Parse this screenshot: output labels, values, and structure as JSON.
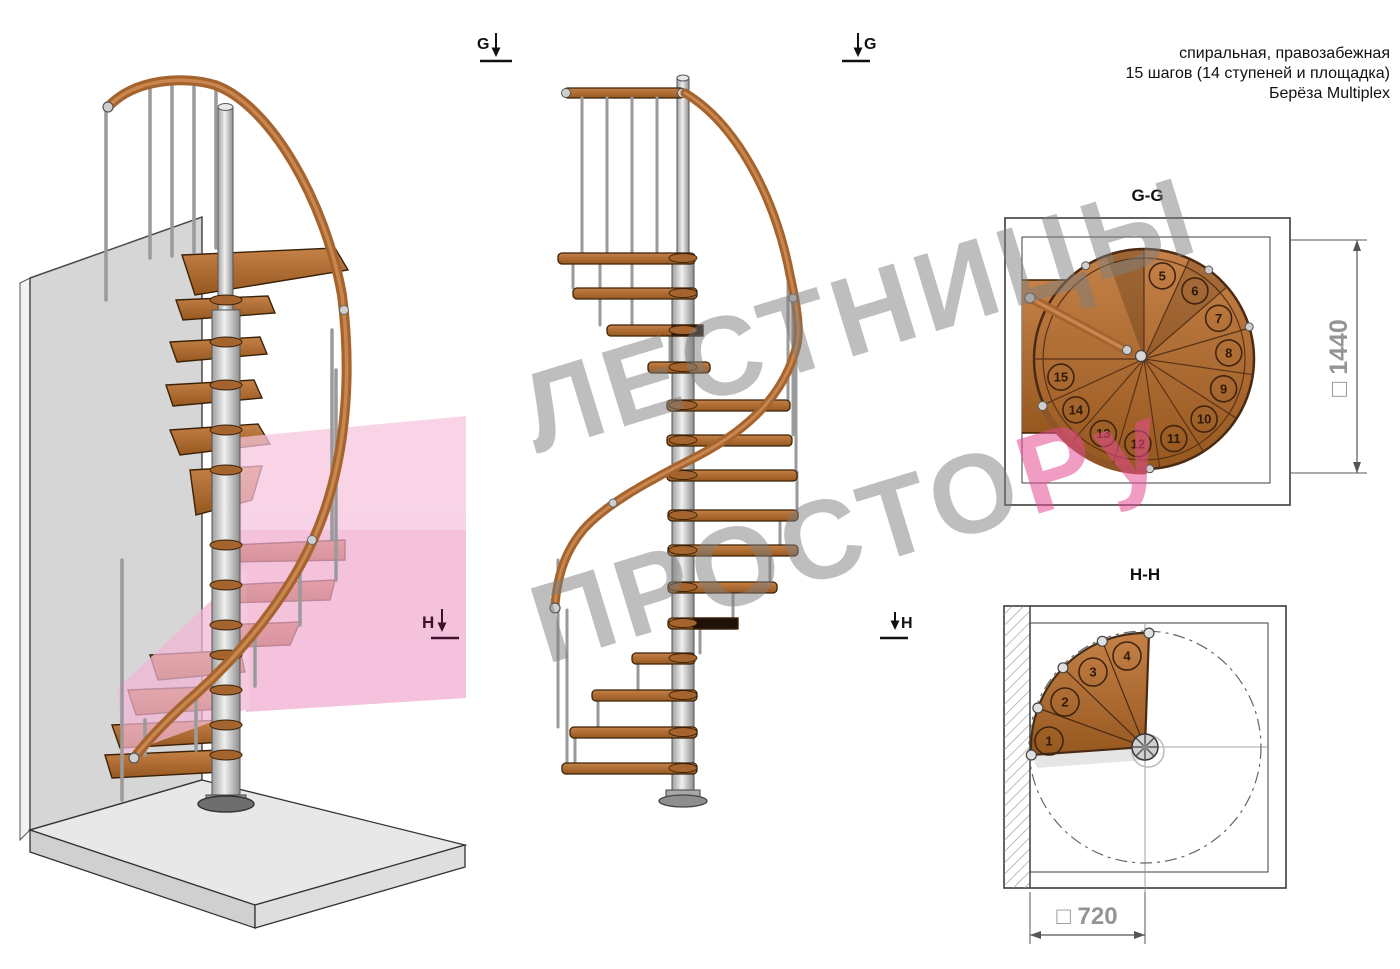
{
  "info": {
    "line1": "спиральная, правозабежная",
    "line2": "15 шагов (14 ступеней и площадка)",
    "line3": "Берёза Multiplex"
  },
  "markers": {
    "g": "G",
    "h": "H"
  },
  "plan_gg": {
    "title": "G-G",
    "dim_label": "□ 1440",
    "steps": [
      "5",
      "6",
      "7",
      "8",
      "9",
      "10",
      "11",
      "12",
      "13",
      "14",
      "15"
    ]
  },
  "plan_hh": {
    "title": "H-H",
    "dim_label": "□ 720",
    "steps": [
      "1",
      "2",
      "3",
      "4"
    ]
  },
  "watermark": {
    "line1": "ЛЕСТНИЦЫ",
    "line2_gray": "ПРОСТО",
    "line2_pink": "Ру"
  },
  "colors": {
    "wood": "#b06c35",
    "wood_dark": "#8a5226",
    "metal": "#d8d8d8",
    "section_pink": "#f2b3d4",
    "watermark_gray": "#a3a3a3",
    "watermark_pink": "#e4598f",
    "dimension_text": "#949494"
  }
}
